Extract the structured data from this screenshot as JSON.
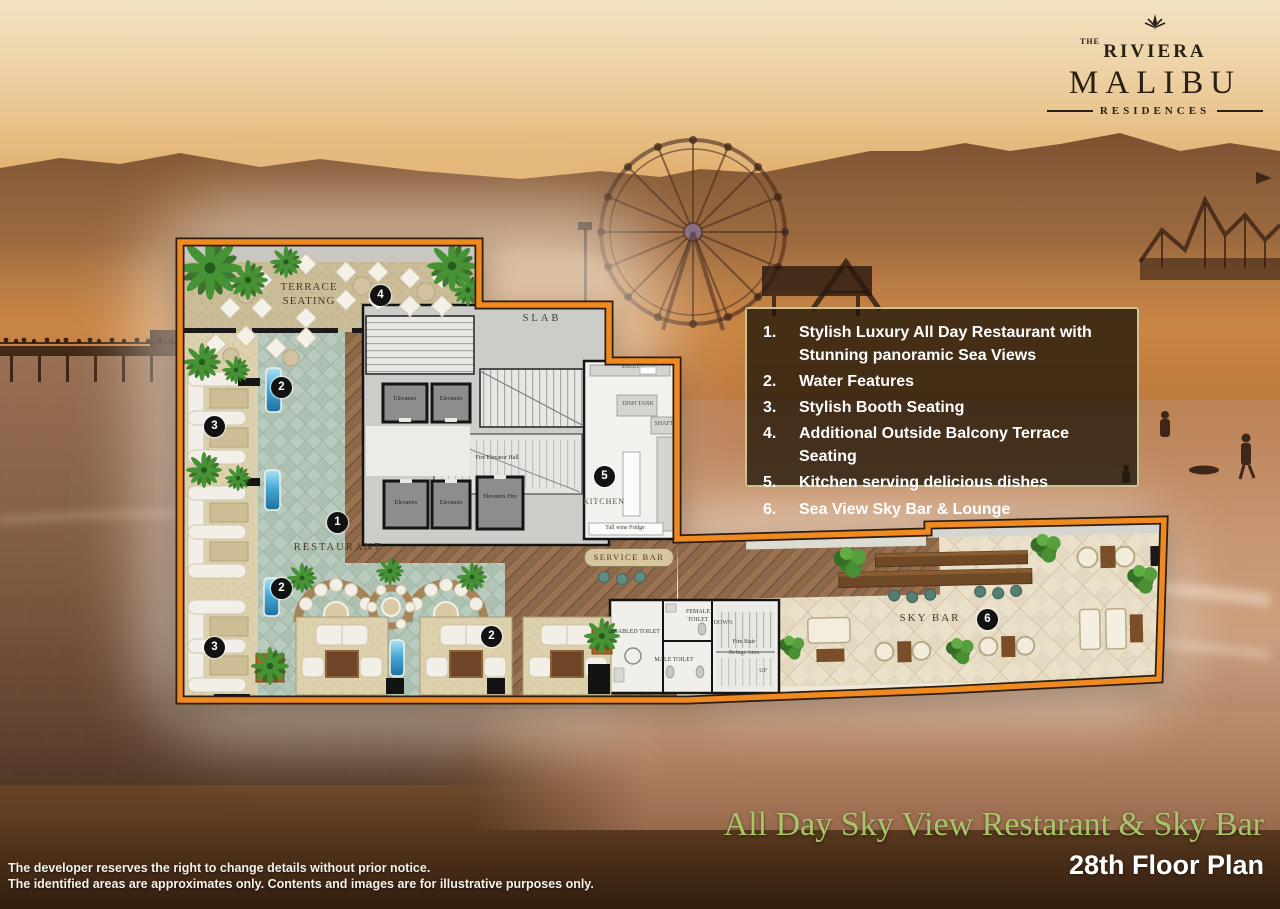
{
  "logo": {
    "the": "THE",
    "riviera": "RIVIERA",
    "malibu": "MALIBU",
    "residences": "RESIDENCES"
  },
  "legend": {
    "items": [
      {
        "num": "1.",
        "text": "Stylish Luxury All Day Restaurant with Stunning panoramic Sea Views"
      },
      {
        "num": "2.",
        "text": "Water Features"
      },
      {
        "num": "3.",
        "text": "Stylish Booth Seating"
      },
      {
        "num": "4.",
        "text": "Additional Outside Balcony Terrace Seating"
      },
      {
        "num": "5.",
        "text": "Kitchen serving delicious dishes"
      },
      {
        "num": "6.",
        "text": "Sea View Sky Bar & Lounge"
      }
    ]
  },
  "plan": {
    "labels": {
      "terrace_seating": "TERRACE SEATING",
      "slab": "SLAB",
      "restaurant": "RESTAURANT",
      "kitchen": "KITCHEN",
      "service_bar": "SERVICE BAR",
      "sky_bar": "SKY BAR",
      "fire_elevator_hall": "Fire Elevator Hall",
      "disabled_toilet": "DISABLED TOILET",
      "female_toilet": "FEMALE TOILET",
      "male_toilet": "MALE TOILET",
      "fire_stair": "Fire Stair",
      "refuge_area": "Refuge Area",
      "down": "DOWN",
      "up": "UP",
      "shelves": "SHELV.",
      "dish_tank": "DISH TANK",
      "shaft": "SHAFT",
      "wine_fridge": "Tall wine Fridge"
    },
    "elevators": [
      "Elevators",
      "Elevators",
      "Elevators",
      "Elevators",
      "Elevators Fire"
    ],
    "badge_numbers": [
      "1",
      "2",
      "3",
      "4",
      "5",
      "6"
    ]
  },
  "titles": {
    "main": "All Day Sky View Restarant & Sky Bar",
    "floor": "28th Floor Plan"
  },
  "disclaimer": {
    "line1": "The developer reserves the right to change details without prior notice.",
    "line2": "The identified areas are approximates only.  Contents and images are for illustrative purposes only."
  },
  "colors": {
    "plan_border": "#ee8a1f",
    "legend_border": "#cbc28d",
    "title_green": "#a9c568",
    "badge": "#121212",
    "water_feature": "#49a9d6"
  }
}
